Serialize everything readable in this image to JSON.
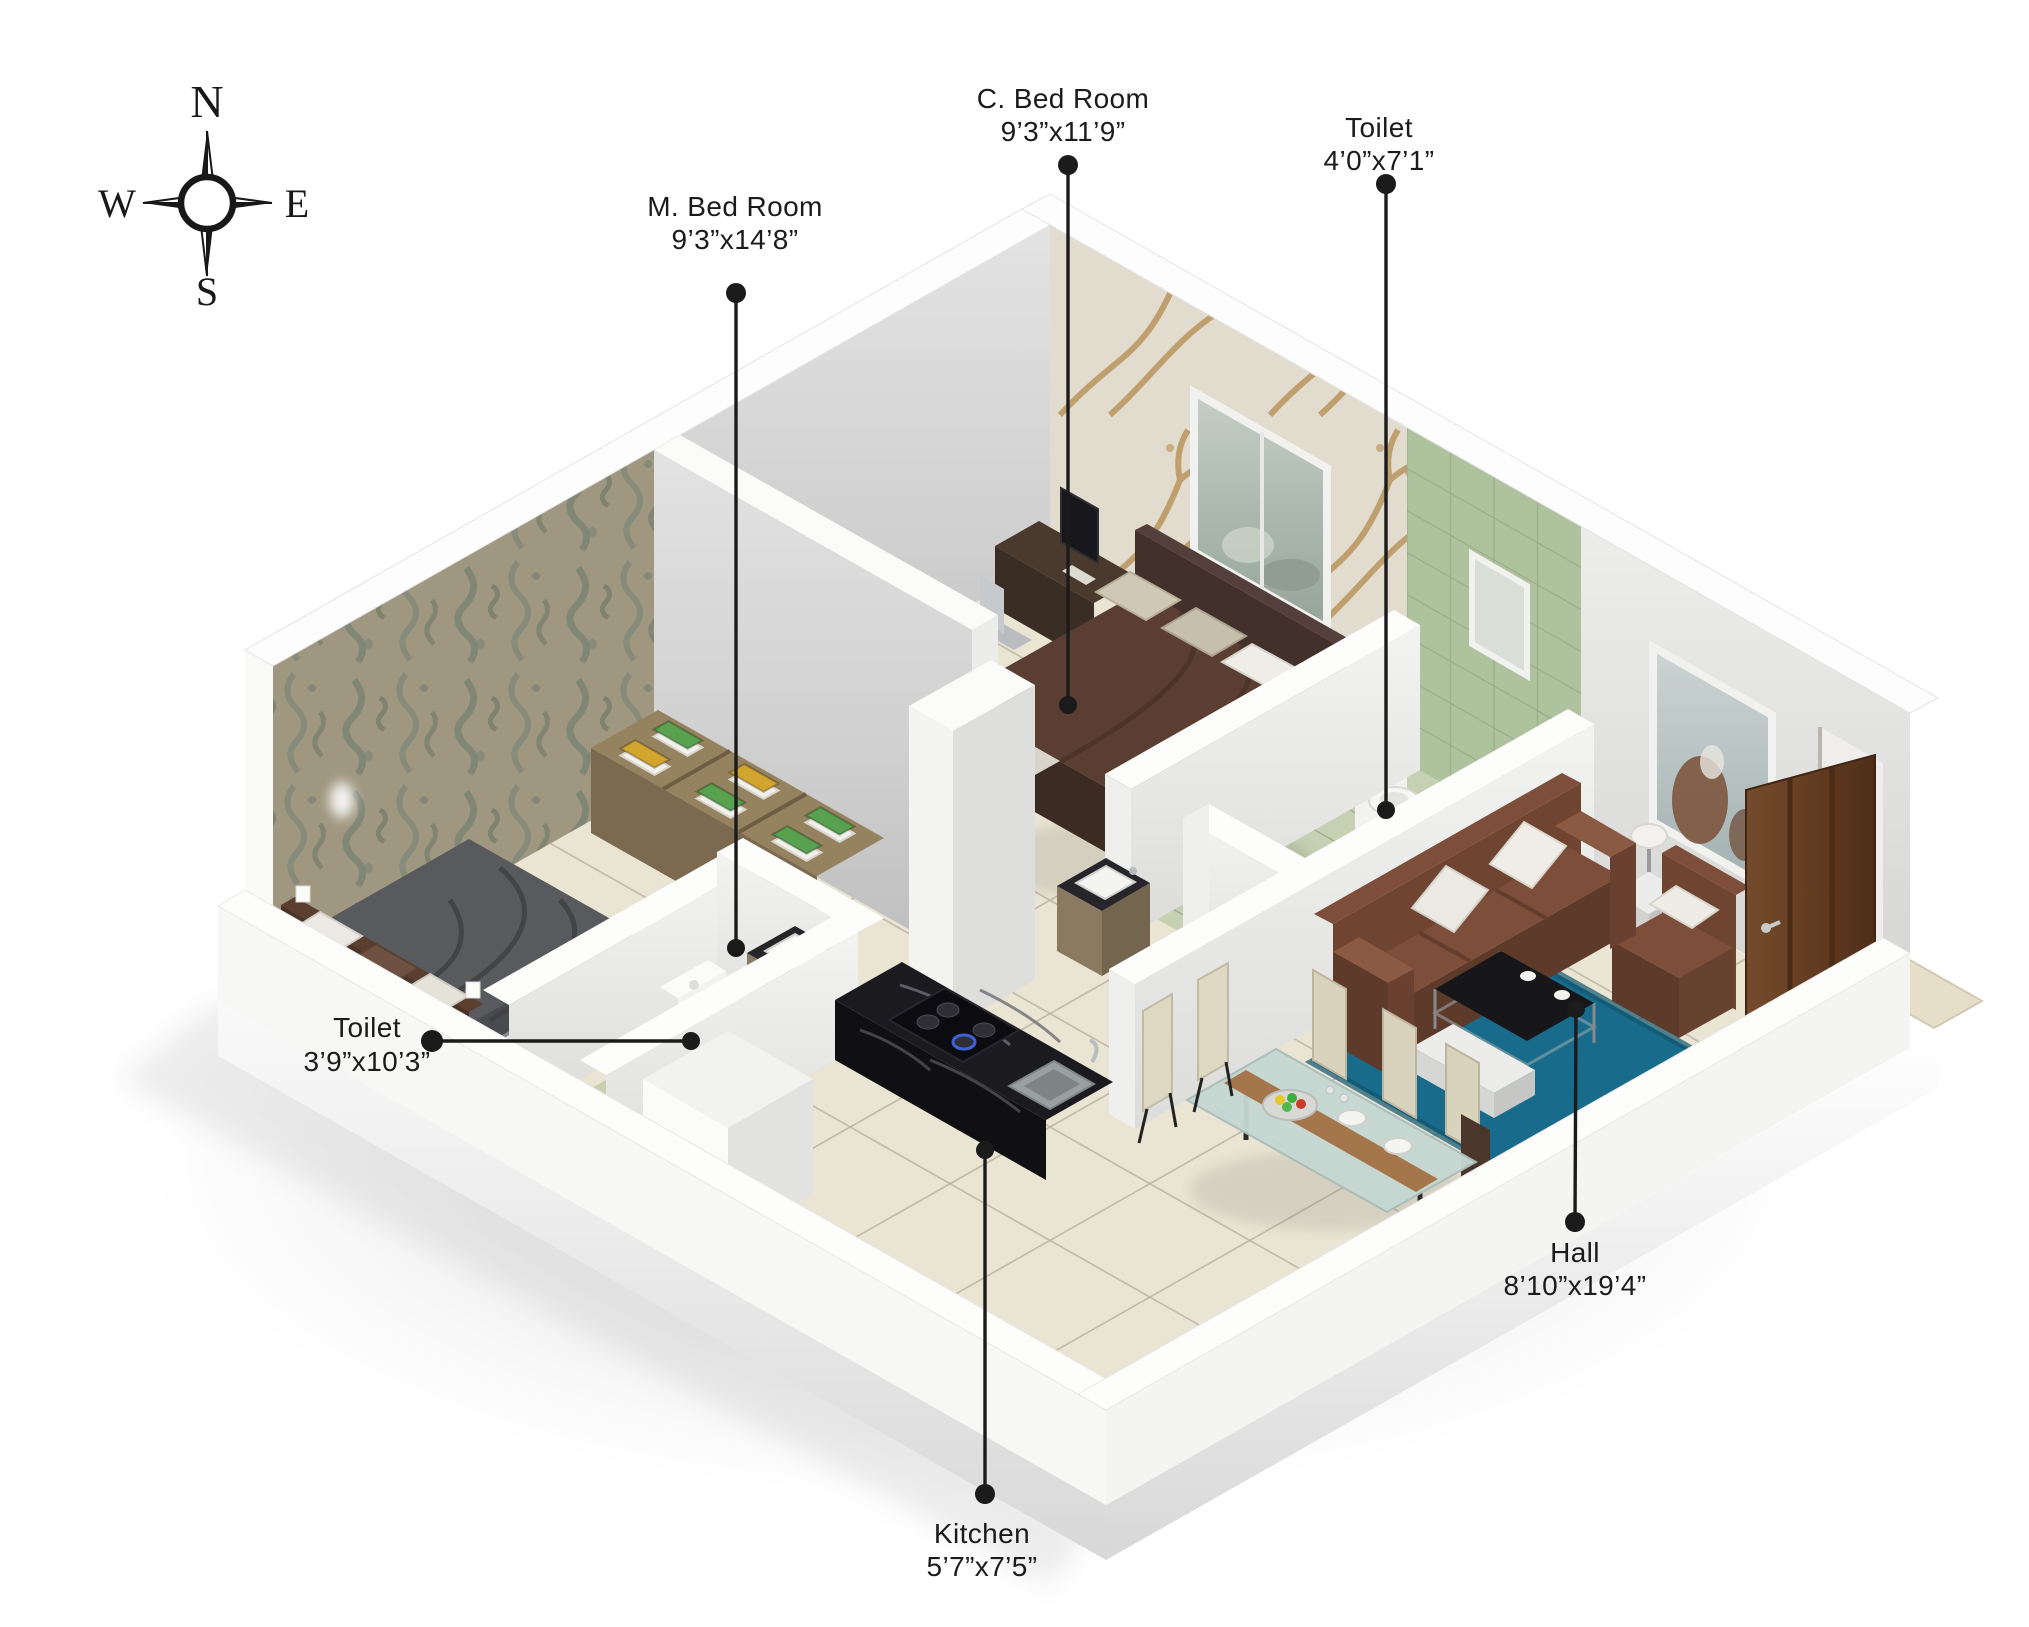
{
  "compass": {
    "north": "N",
    "east": "E",
    "south": "S",
    "west": "W"
  },
  "rooms": {
    "m_bedroom": {
      "label": "M. Bed Room",
      "dimensions": "9’3”x14’8”"
    },
    "c_bedroom": {
      "label": "C. Bed Room",
      "dimensions": "9’3”x11’9”"
    },
    "toilet_attached": {
      "label": "Toilet",
      "dimensions": "4’0”x7’1”"
    },
    "toilet_common": {
      "label": "Toilet",
      "dimensions": "3’9”x10’3”"
    },
    "hall": {
      "label": "Hall",
      "dimensions": "8’10”x19’4”"
    },
    "kitchen": {
      "label": "Kitchen",
      "dimensions": "5’7”x7’5”"
    }
  },
  "colors": {
    "label_text": "#1b1b1b",
    "leader_line": "#1b1b1b",
    "floor_tile": "#eae4d3",
    "floor_grout": "#bdb5a3",
    "toilet_floor_tile": "#c6d0b2",
    "toilet_wall_tile": "#aec29d",
    "wall_interior": "#d6d6d6",
    "wall_exterior": "#f7f7f7",
    "damask_wallpaper": "#b1a88e",
    "tree_wallpaper": "#efe8da",
    "tree_wallpaper_branch": "#c49c63",
    "sofa_brown": "#7a4c36",
    "rug_teal": "#186b8b",
    "master_bed_gray": "#595a5e",
    "child_bed_brown": "#5a3e31",
    "kitchen_counter_black": "#17171a",
    "towel_green": "#58a14e",
    "towel_yellow": "#d2a52f",
    "door_wood": "#6a4126"
  }
}
